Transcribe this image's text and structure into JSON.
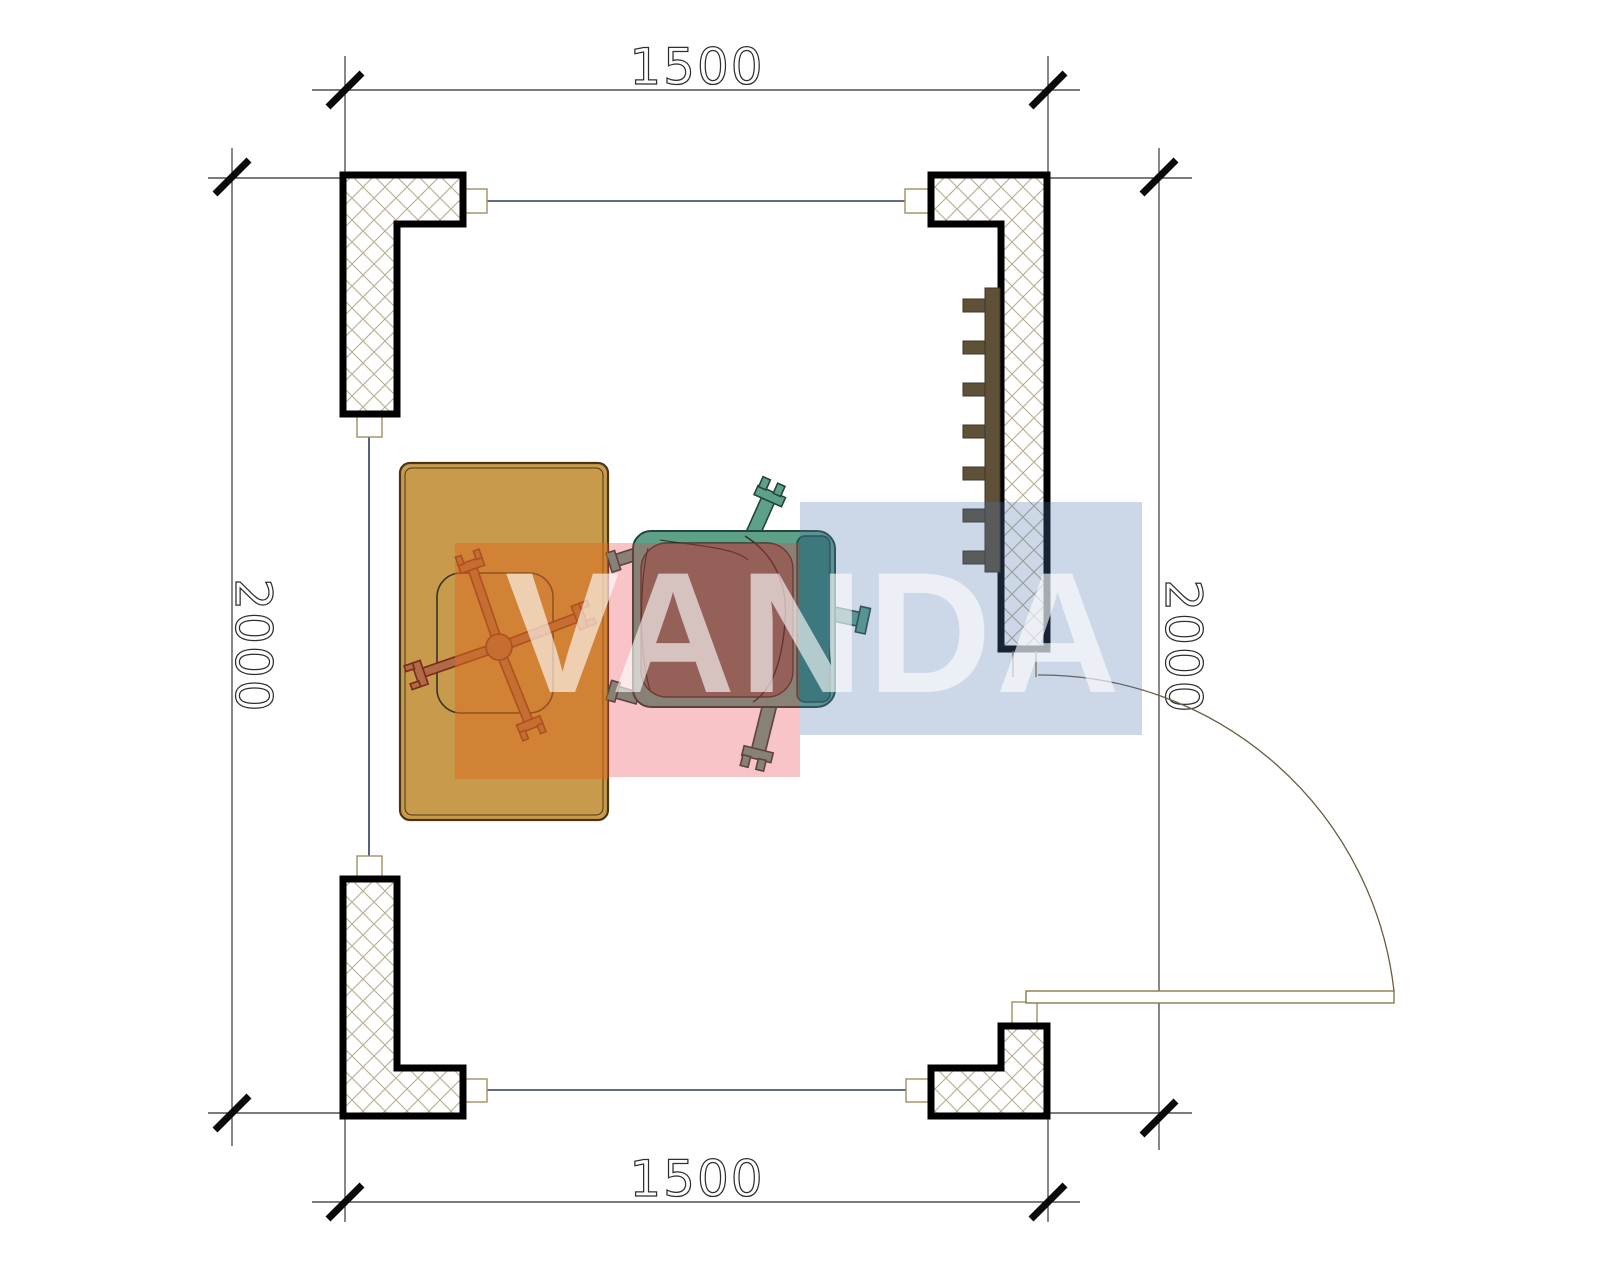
{
  "drawing": {
    "type": "floor-plan",
    "dimensions": {
      "top": "1500",
      "bottom": "1500",
      "left": "2000",
      "right": "2000"
    },
    "watermark": {
      "text": "VANDA",
      "block_orange": "rgba(217,112,32,0.55)",
      "block_red": "rgba(233,58,74,0.30)",
      "block_blue": "rgba(78,116,176,0.29)"
    },
    "colors": {
      "wall_outline": "#000000",
      "hatch": "#b8ad90",
      "frame_line": "#2b3a5e",
      "stub_line": "#a09060",
      "door_line": "#8a7a4a",
      "dim_line": "#2f2f2f",
      "desk": "#c89a4c",
      "desk_outline": "#4a3516",
      "chair_base": "#7a2a1c",
      "armchair_teal": "#5ea189",
      "armchair_back": "#357a69",
      "armchair_cushion": "#70705e",
      "radiator": "#5e5138"
    },
    "furniture": {
      "desk": "desk",
      "office_chair": "office-chair",
      "armchair": "armchair",
      "radiator": "radiator",
      "door": "door"
    }
  }
}
